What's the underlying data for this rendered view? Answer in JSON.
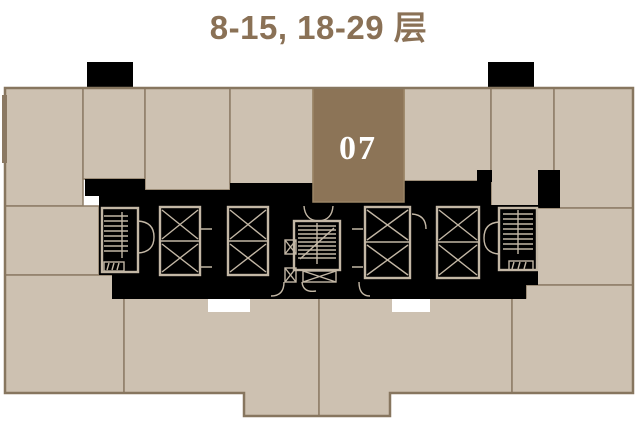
{
  "header": {
    "title": "8-15, 18-29 层"
  },
  "plan": {
    "highlighted_unit": {
      "label": "07",
      "fill": "#8c7457",
      "text_color": "#ffffff"
    },
    "colors": {
      "background": "#ffffff",
      "unit_fill": "#cdc1b1",
      "unit_border": "#8d7c66",
      "core_black": "#000000",
      "core_linework": "#c3b7a5",
      "plan_outline": "#87765f",
      "title_color": "#8a7156"
    }
  }
}
